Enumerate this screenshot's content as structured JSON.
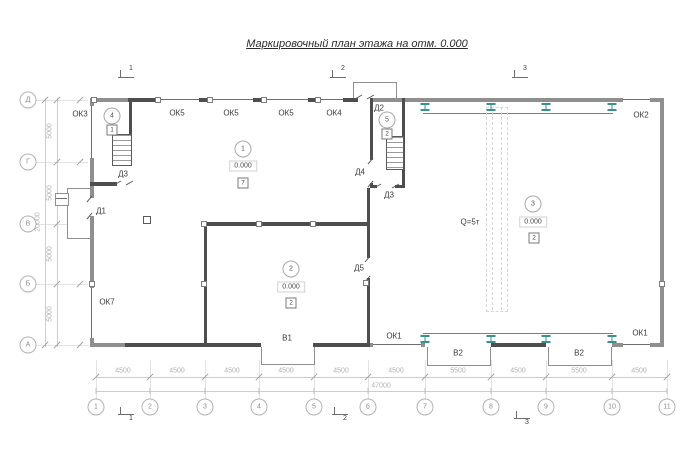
{
  "title": "Маркировочный план этажа на отм. 0.000",
  "grid": {
    "cols": [
      "1",
      "2",
      "3",
      "4",
      "5",
      "6",
      "7",
      "8",
      "9",
      "10",
      "11"
    ],
    "rows": [
      "Д",
      "Г",
      "В",
      "Б",
      "А"
    ],
    "col_dims": [
      "4500",
      "4500",
      "4500",
      "4500",
      "4500",
      "4500",
      "5500",
      "4500",
      "5500",
      "4500"
    ],
    "row_dims": [
      "5000",
      "5000",
      "5000",
      "5000"
    ],
    "total_width": "47000",
    "total_height": "20000"
  },
  "sections": {
    "top": [
      "1",
      "2",
      "3"
    ],
    "bottom": [
      "1",
      "2",
      "3"
    ]
  },
  "rooms": {
    "r1": {
      "num": "1",
      "elev": "0.000",
      "mark": "7"
    },
    "r2": {
      "num": "2",
      "elev": "0.000",
      "mark": "2"
    },
    "r3": {
      "num": "3",
      "elev": "0.000",
      "mark": "2"
    },
    "r4": {
      "num": "4",
      "mark": "1"
    },
    "r5": {
      "num": "5",
      "mark": "2"
    }
  },
  "labels": {
    "ok3": "ОК3",
    "ok5_1": "ОК5",
    "ok5_2": "ОК5",
    "ok5_3": "ОК5",
    "ok4": "ОК4",
    "ok2": "ОК2",
    "ok7": "ОК7",
    "ok1_left": "ОК1",
    "ok1_right": "ОК1",
    "d1": "Д1",
    "d2": "Д2",
    "d3_left": "Д3",
    "d3_mid": "Д3",
    "d4": "Д4",
    "d5": "Д5",
    "v1": "В1",
    "v2_left": "В2",
    "v2_right": "В2"
  },
  "crane": {
    "capacity": "Q=5т"
  },
  "colors": {
    "crane_support": "#3a8f8f",
    "wall": "#8f8f8f",
    "wall_dark": "#4e4e4e",
    "grid_line": "#cdcdcd"
  }
}
